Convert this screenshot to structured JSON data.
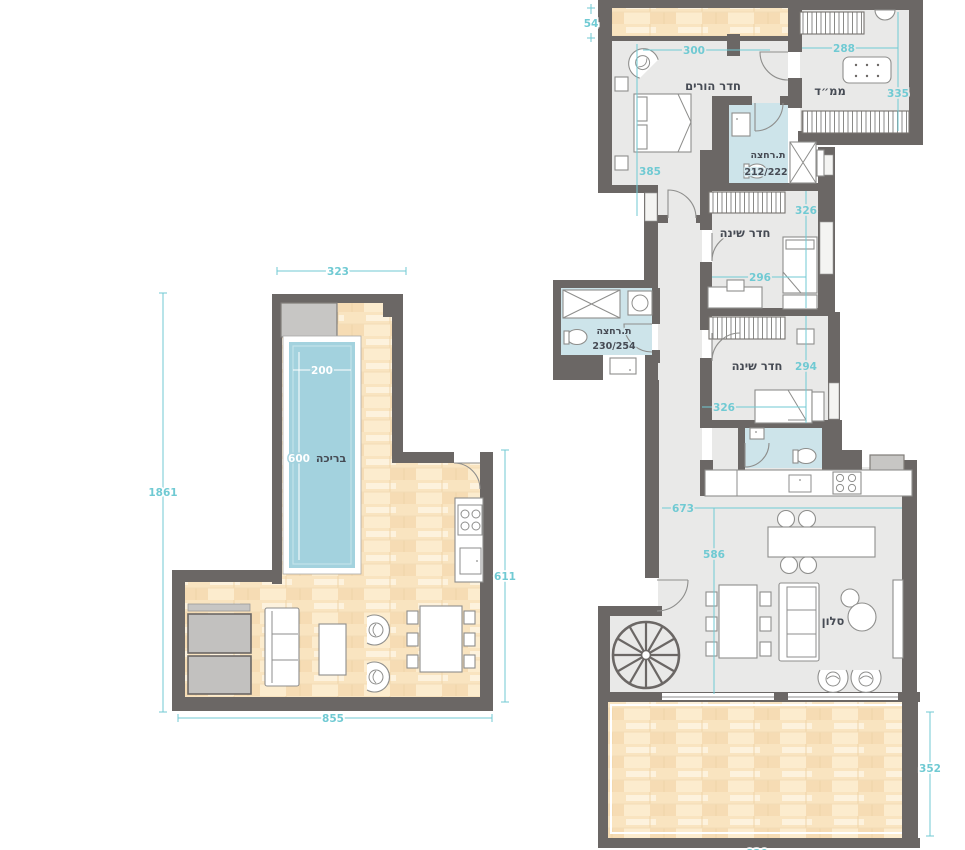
{
  "title": "apartment-floor-plans",
  "colors": {
    "wall": "#6b6765",
    "floor": "#e9e9e8",
    "wet_room": "#cde4ea",
    "pool": "#a3d2de",
    "wood_deck": "#fcecce",
    "dimension": "#70cad3",
    "label": "#464b54"
  },
  "left_plan": {
    "name": "roof-deck-level",
    "pool": {
      "label": "בריכה",
      "width": "200",
      "length": "600"
    },
    "dims": {
      "top": "323",
      "side": "1861",
      "bottom": "855",
      "right": "611"
    }
  },
  "right_plan": {
    "name": "apartment-level",
    "rooms": {
      "master": {
        "label": "חדר הורים"
      },
      "mamad": {
        "label": "ממ״ד"
      },
      "bath1": {
        "label": "ת.רחצה",
        "size": "212/222"
      },
      "bedroom1": {
        "label": "חדר שינה"
      },
      "bedroom2": {
        "label": "חדר שינה"
      },
      "bath2": {
        "label": "ת.רחצה",
        "size": "230/254"
      },
      "living": {
        "label": "סלון"
      }
    },
    "dims": {
      "strip": "54",
      "master_width": "300",
      "master_height": "385",
      "mamad_width": "288",
      "mamad_height": "335",
      "bedroom1_height": "326",
      "bedroom1_width": "296",
      "bedroom2_height": "294",
      "bedroom2_width": "326",
      "living_width": "673",
      "living_height": "586",
      "terrace_height": "352",
      "terrace_bottom": "820"
    }
  }
}
